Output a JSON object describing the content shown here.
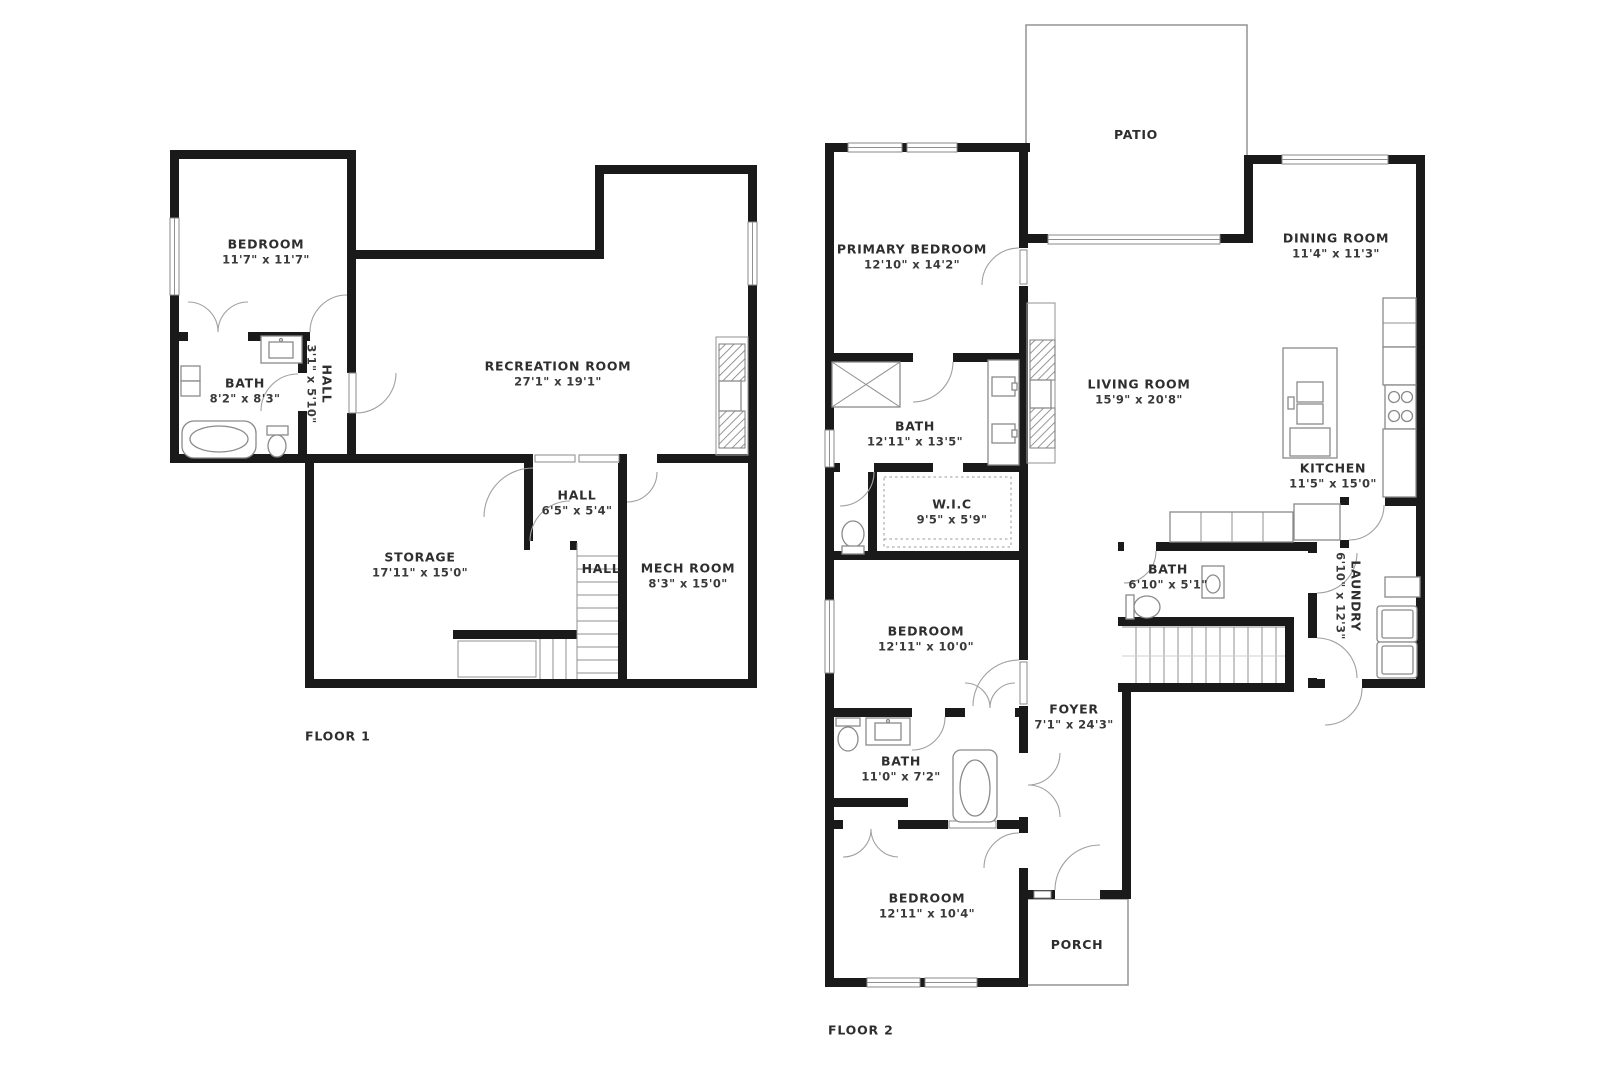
{
  "page": {
    "background": "#ffffff",
    "wall_color": "#1a1a1a",
    "line_color": "#9a9a9a",
    "text_color": "#2e2e2e"
  },
  "floors": [
    {
      "label": "FLOOR 1",
      "rooms": [
        {
          "id": "bedroom",
          "name": "BEDROOM",
          "dims": "11'7\" x 11'7\""
        },
        {
          "id": "bath",
          "name": "BATH",
          "dims": "8'2\" x 8'3\""
        },
        {
          "id": "hall-small",
          "name": "HALL",
          "dims": "3'1\" x 5'10\""
        },
        {
          "id": "recreation-room",
          "name": "RECREATION ROOM",
          "dims": "27'1\" x 19'1\""
        },
        {
          "id": "hall",
          "name": "HALL",
          "dims": "6'5\" x 5'4\""
        },
        {
          "id": "storage",
          "name": "STORAGE",
          "dims": "17'11\" x 15'0\""
        },
        {
          "id": "hall-2",
          "name": "HALL",
          "dims": ""
        },
        {
          "id": "mech-room",
          "name": "MECH ROOM",
          "dims": "8'3\" x 15'0\""
        }
      ]
    },
    {
      "label": "FLOOR 2",
      "rooms": [
        {
          "id": "patio",
          "name": "PATIO",
          "dims": ""
        },
        {
          "id": "primary-bedroom",
          "name": "PRIMARY BEDROOM",
          "dims": "12'10\" x 14'2\""
        },
        {
          "id": "dining-room",
          "name": "DINING ROOM",
          "dims": "11'4\" x 11'3\""
        },
        {
          "id": "living-room",
          "name": "LIVING ROOM",
          "dims": "15'9\" x 20'8\""
        },
        {
          "id": "bath-primary",
          "name": "BATH",
          "dims": "12'11\" x 13'5\""
        },
        {
          "id": "kitchen",
          "name": "KITCHEN",
          "dims": "11'5\" x 15'0\""
        },
        {
          "id": "wic",
          "name": "W.I.C",
          "dims": "9'5\" x 5'9\""
        },
        {
          "id": "bath-upper",
          "name": "BATH",
          "dims": "6'10\" x 5'1\""
        },
        {
          "id": "laundry",
          "name": "LAUNDRY",
          "dims": "6'10\" x 12'3\""
        },
        {
          "id": "bedroom-middle",
          "name": "BEDROOM",
          "dims": "12'11\" x 10'0\""
        },
        {
          "id": "foyer",
          "name": "FOYER",
          "dims": "7'1\" x 24'3\""
        },
        {
          "id": "bath-middle",
          "name": "BATH",
          "dims": "11'0\" x 7'2\""
        },
        {
          "id": "bedroom-lower",
          "name": "BEDROOM",
          "dims": "12'11\" x 10'4\""
        },
        {
          "id": "porch",
          "name": "PORCH",
          "dims": ""
        }
      ]
    }
  ]
}
